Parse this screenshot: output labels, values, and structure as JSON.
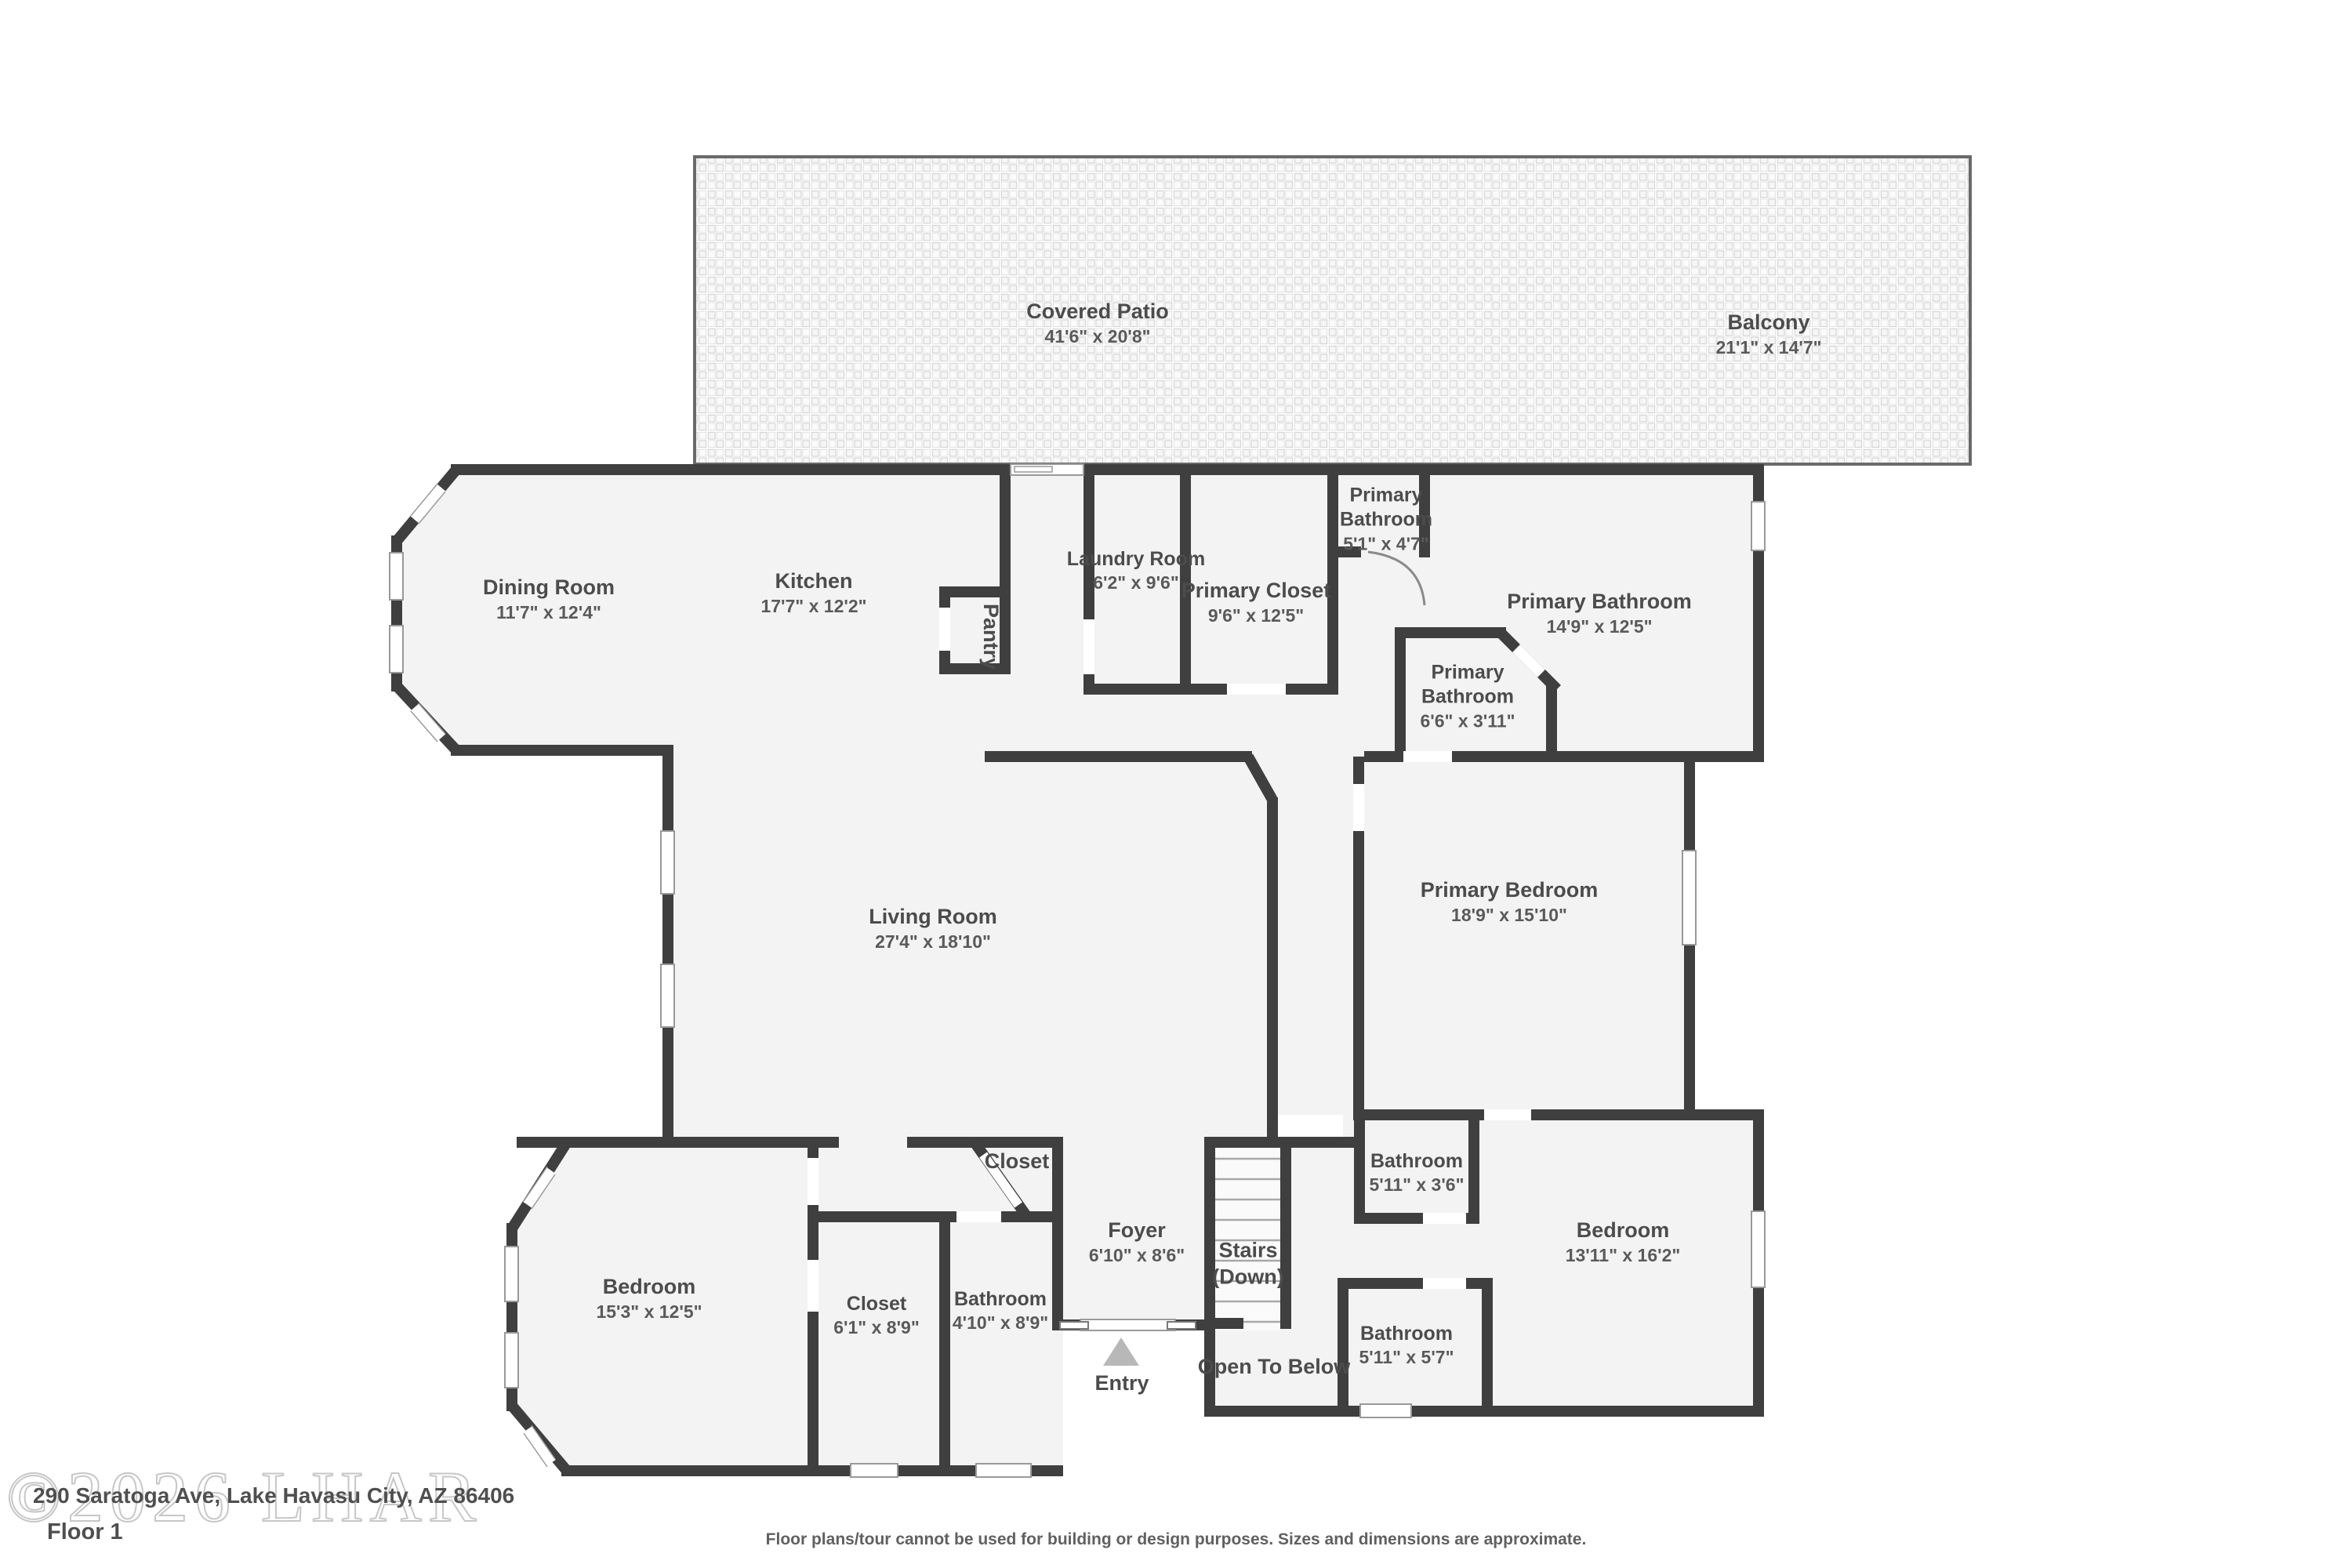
{
  "meta": {
    "floor_label": "Floor 1",
    "address": "290 Saratoga Ave, Lake Havasu City, AZ 86406",
    "disclaimer": "Floor plans/tour cannot be used for building or design purposes. Sizes and dimensions are approximate.",
    "watermark": "©2026 LHAR"
  },
  "colors": {
    "wall": "#3f3f3f",
    "room_fill": "#f3f3f3",
    "patio_fill": "#fbfbfb",
    "label_text": "#4c4c4c",
    "dims_text": "#5a5a5a",
    "entry_arrow": "#b8b8b8"
  },
  "rooms": [
    {
      "id": "covered-patio",
      "name": "Covered Patio",
      "dims": "41'6\" x 20'8\""
    },
    {
      "id": "balcony",
      "name": "Balcony",
      "dims": "21'1\" x 14'7\""
    },
    {
      "id": "dining-room",
      "name": "Dining Room",
      "dims": "11'7\" x 12'4\""
    },
    {
      "id": "kitchen",
      "name": "Kitchen",
      "dims": "17'7\" x 12'2\""
    },
    {
      "id": "laundry-room",
      "name": "Laundry Room",
      "dims": "6'2\" x 9'6\""
    },
    {
      "id": "primary-closet",
      "name": "Primary Closet",
      "dims": "9'6\" x 12'5\""
    },
    {
      "id": "primary-bathroom-wc",
      "name": "Primary Bathroom",
      "dims": "5'1\" x 4'7\""
    },
    {
      "id": "primary-bathroom",
      "name": "Primary Bathroom",
      "dims": "14'9\" x 12'5\""
    },
    {
      "id": "primary-bathroom-sm",
      "name": "Primary Bathroom",
      "dims": "6'6\" x 3'11\""
    },
    {
      "id": "pantry",
      "name": "Pantry",
      "dims": ""
    },
    {
      "id": "living-room",
      "name": "Living Room",
      "dims": "27'4\" x 18'10\""
    },
    {
      "id": "primary-bedroom",
      "name": "Primary Bedroom",
      "dims": "18'9\" x 15'10\""
    },
    {
      "id": "closet-foyer",
      "name": "Closet",
      "dims": ""
    },
    {
      "id": "foyer",
      "name": "Foyer",
      "dims": "6'10\" x 8'6\""
    },
    {
      "id": "stairs",
      "name": "Stairs",
      "dims": "(Down)"
    },
    {
      "id": "bathroom-upper",
      "name": "Bathroom",
      "dims": "5'11\" x 3'6\""
    },
    {
      "id": "bedroom-right",
      "name": "Bedroom",
      "dims": "13'11\" x 16'2\""
    },
    {
      "id": "bedroom-left",
      "name": "Bedroom",
      "dims": "15'3\" x 12'5\""
    },
    {
      "id": "closet-left",
      "name": "Closet",
      "dims": "6'1\" x 8'9\""
    },
    {
      "id": "bathroom-left",
      "name": "Bathroom",
      "dims": "4'10\" x 8'9\""
    },
    {
      "id": "bathroom-lower",
      "name": "Bathroom",
      "dims": "5'11\" x 5'7\""
    },
    {
      "id": "open-to-below",
      "name": "Open To Below",
      "dims": ""
    },
    {
      "id": "entry",
      "name": "Entry",
      "dims": ""
    }
  ]
}
